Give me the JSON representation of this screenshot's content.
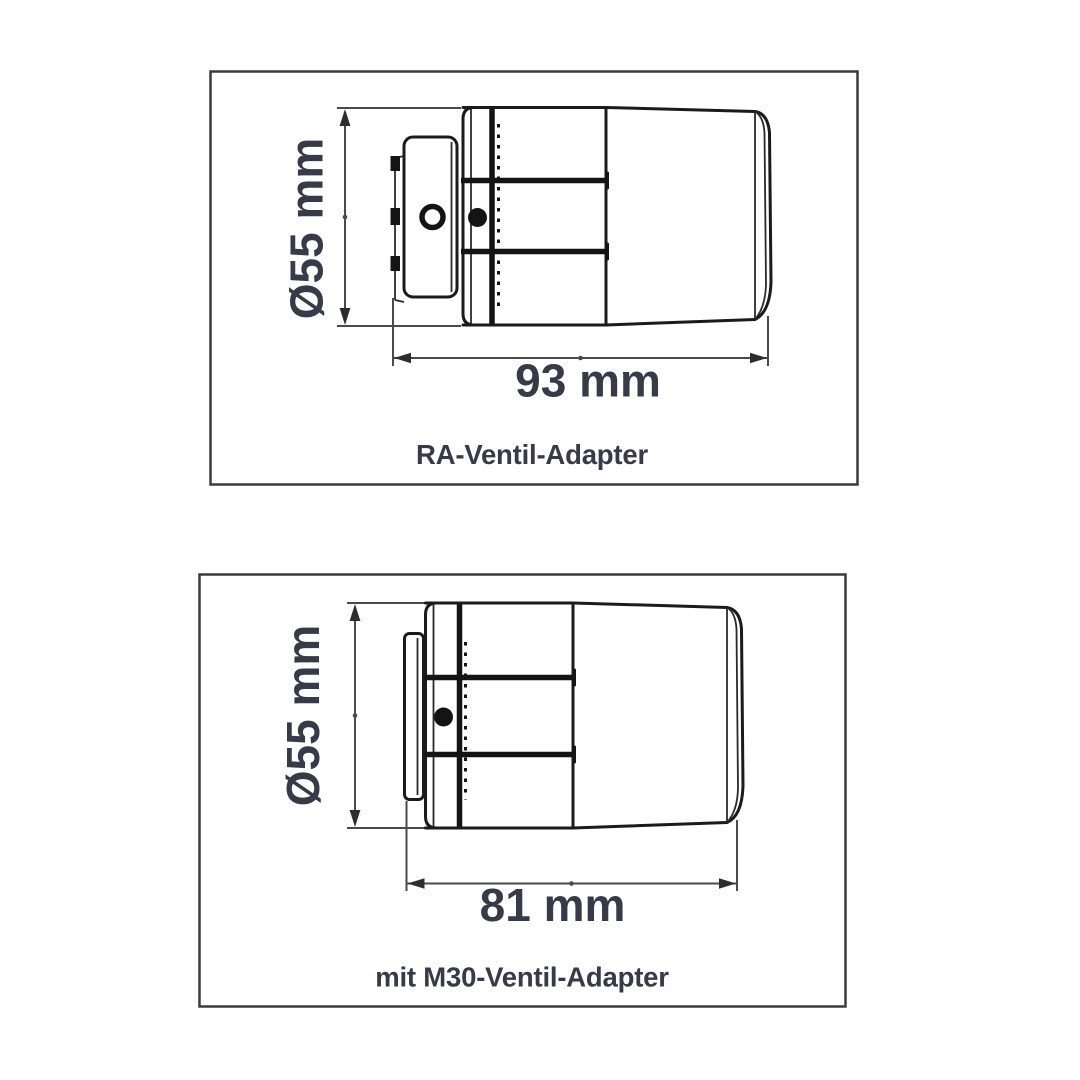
{
  "figure": {
    "background": "#ffffff",
    "panels": [
      {
        "caption": "RA-Ventil-Adapter",
        "diameter_label": "Ø55 mm",
        "length_label": "93 mm"
      },
      {
        "caption": "mit M30-Ventil-Adapter",
        "diameter_label": "Ø55 mm",
        "length_label": "81 mm"
      }
    ],
    "colors": {
      "outline": "#1b1b1b",
      "dimension_lines": "#4a4a4a",
      "label_text": "#363a49",
      "panel_border": "#3b3b3b"
    }
  }
}
